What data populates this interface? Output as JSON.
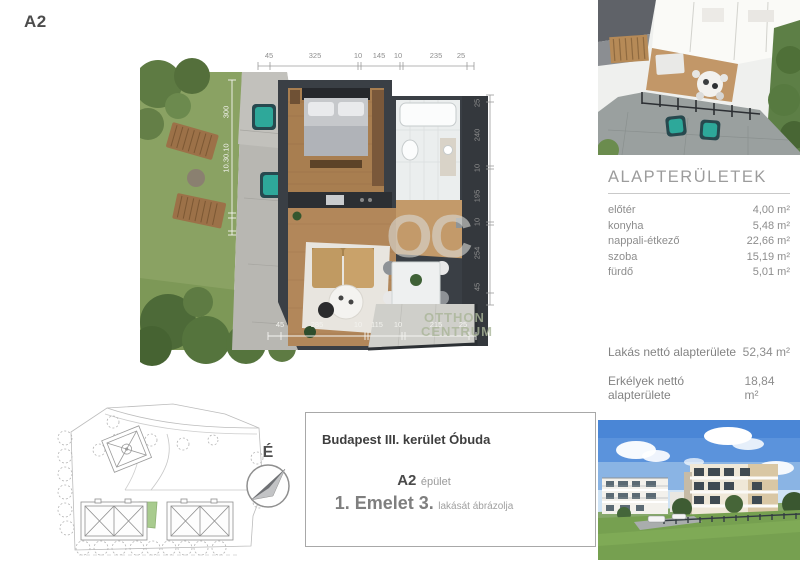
{
  "page": {
    "sheet_label": "A2"
  },
  "floor_plan": {
    "dims_top": [
      "45",
      "325",
      "10",
      "145",
      "10",
      "235",
      "25"
    ],
    "dims_bottom": [
      "45",
      "285",
      "10",
      "115",
      "10",
      "215",
      "25"
    ],
    "dims_right": [
      "25",
      "240",
      "10",
      "195",
      "10",
      "254",
      "45"
    ],
    "dims_left": [
      "300",
      "10.30.10"
    ],
    "watermark": {
      "logo": "OC",
      "line1": "OTTHON",
      "line2": "CENTRUM"
    }
  },
  "areas_panel": {
    "title": "ALAPTERÜLETEK",
    "rows": [
      {
        "label": "előtér",
        "value": "4,00 m²"
      },
      {
        "label": "konyha",
        "value": "5,48 m²"
      },
      {
        "label": "nappali-étkező",
        "value": "22,66 m²"
      },
      {
        "label": "szoba",
        "value": "15,19 m²"
      },
      {
        "label": "fürdő",
        "value": "5,01 m²"
      }
    ],
    "totals": [
      {
        "label": "Lakás nettó alapterülete",
        "value": "52,34 m²"
      },
      {
        "label": "Erkélyek nettó alapterülete",
        "value": "18,84 m²"
      }
    ],
    "disclaimer": [
      "A megadott alapterületek és méretek tájékoztató jellegűek.",
      "Az ábrázolt berendezés illusztráció."
    ]
  },
  "info_box": {
    "location": "Budapest III. kerület Óbuda",
    "building_code": "A2",
    "building_word": "épület",
    "floor_unit": "1. Emelet 3.",
    "unit_word": "lakását ábrázolja"
  },
  "compass": {
    "north": "É"
  },
  "colors": {
    "accent_teal": "#2ea89a",
    "wood": "#b2875a",
    "grass": "#8aa263",
    "text_gray": "#8d8d8d"
  }
}
